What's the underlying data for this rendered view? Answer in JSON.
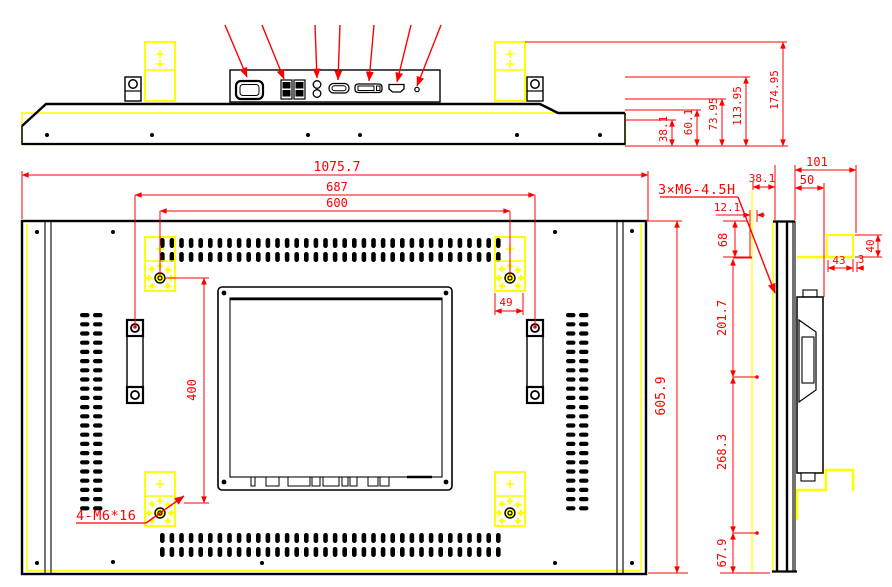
{
  "colors": {
    "dimension": "#ff0000",
    "highlight": "#ffff00",
    "line": "#000000",
    "background": "#ffffff"
  },
  "top_view": {
    "height_dims": [
      "38.1",
      "60.1",
      "73.95",
      "113.95",
      "174.95"
    ]
  },
  "rear_view": {
    "width_dims": [
      "1075.7",
      "687",
      "600"
    ],
    "height_dim": "605.9",
    "vesa_height_dim": "400",
    "bracket_offset_dim": "49",
    "mount_screw_note": "4-M6*16"
  },
  "side_view": {
    "side_hole_note": "3×M6-4.5H",
    "depth_dims": [
      "12.1",
      "38.1",
      "50",
      "101"
    ],
    "height_dims": [
      "68",
      "201.7",
      "268.3",
      "67.9"
    ],
    "bracket_dims": [
      "40",
      "43",
      "3"
    ]
  }
}
